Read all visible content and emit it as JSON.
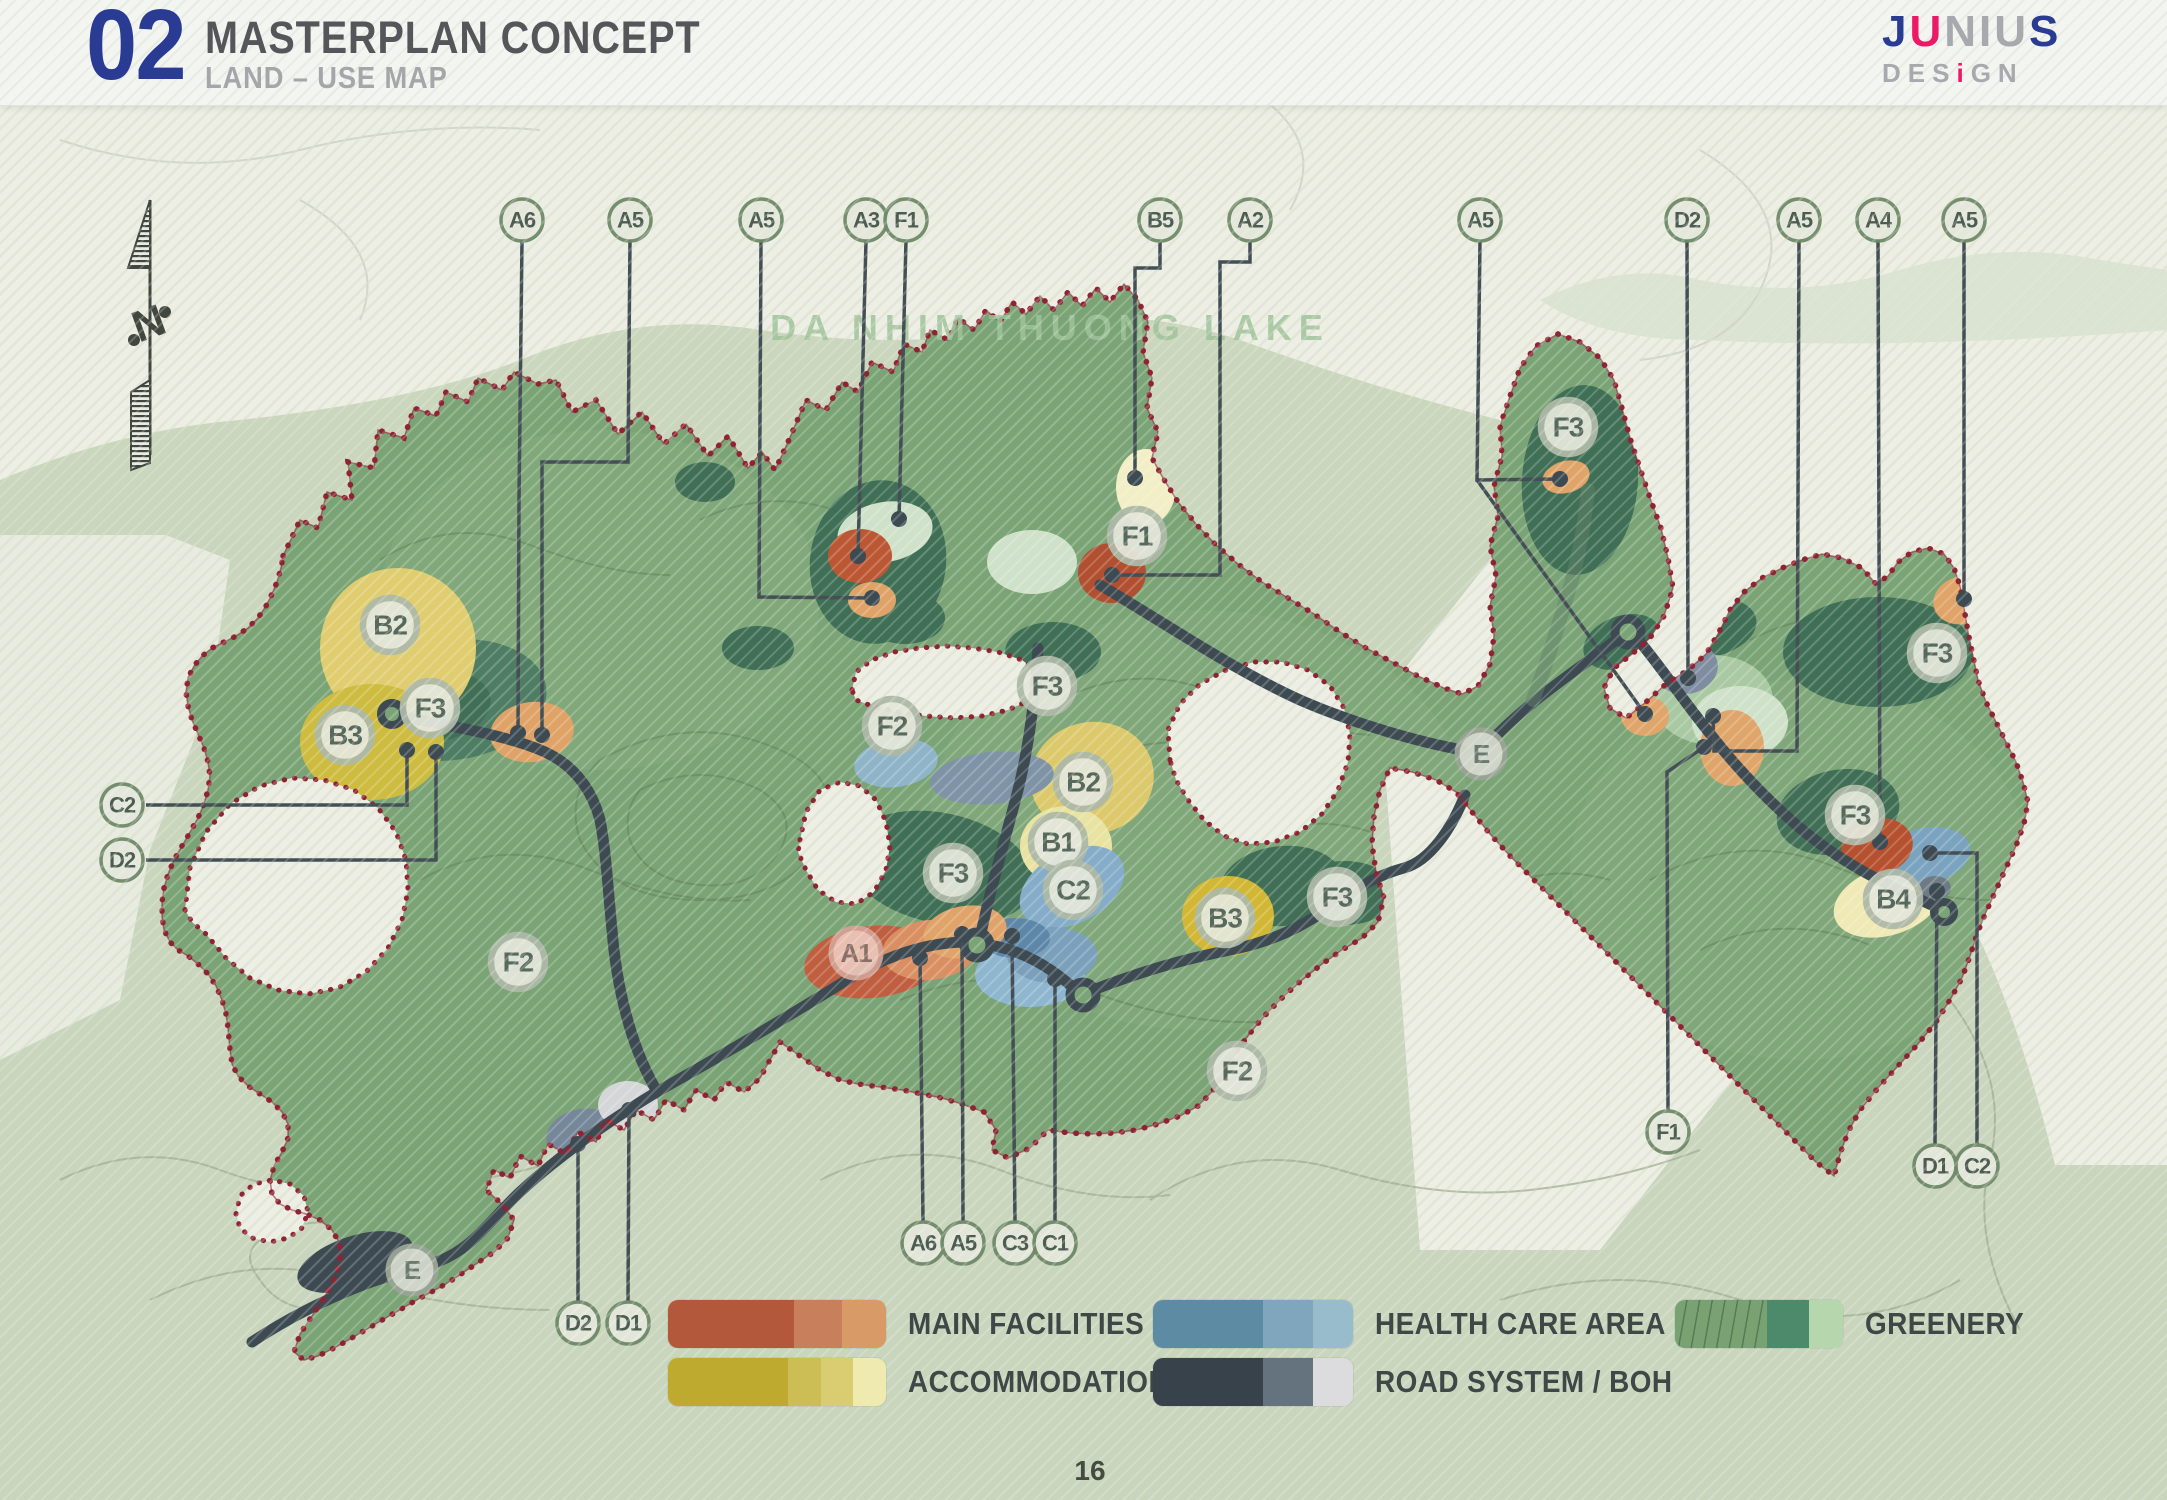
{
  "header": {
    "number": "02",
    "title": "MASTERPLAN CONCEPT",
    "subtitle": "LAND – USE MAP"
  },
  "logo": {
    "line1_j": "J",
    "line1_u": "U",
    "line1_rest": "NIU",
    "line1_s": "S",
    "line2_pre": "DES",
    "line2_i": "i",
    "line2_post": "GN"
  },
  "map": {
    "lake_label": "DA NHIM THUONG LAKE",
    "north_label": "N",
    "markers": [
      {
        "label": "B2",
        "x": 390,
        "y": 625,
        "kind": "zone"
      },
      {
        "label": "B3",
        "x": 345,
        "y": 735,
        "kind": "zone"
      },
      {
        "label": "F3",
        "x": 430,
        "y": 708,
        "kind": "zone"
      },
      {
        "label": "F2",
        "x": 518,
        "y": 962,
        "kind": "zone"
      },
      {
        "label": "F2",
        "x": 892,
        "y": 726,
        "kind": "zone"
      },
      {
        "label": "F3",
        "x": 1047,
        "y": 686,
        "kind": "zone"
      },
      {
        "label": "F1",
        "x": 1137,
        "y": 536,
        "kind": "zone"
      },
      {
        "label": "B2",
        "x": 1083,
        "y": 782,
        "kind": "zone"
      },
      {
        "label": "B1",
        "x": 1058,
        "y": 842,
        "kind": "zone"
      },
      {
        "label": "C2",
        "x": 1073,
        "y": 890,
        "kind": "zone"
      },
      {
        "label": "F3",
        "x": 953,
        "y": 873,
        "kind": "zone"
      },
      {
        "label": "B3",
        "x": 1225,
        "y": 918,
        "kind": "zone"
      },
      {
        "label": "F3",
        "x": 1337,
        "y": 897,
        "kind": "zone"
      },
      {
        "label": "F2",
        "x": 1237,
        "y": 1071,
        "kind": "zone"
      },
      {
        "label": "E",
        "x": 1481,
        "y": 754,
        "kind": "e"
      },
      {
        "label": "F3",
        "x": 1568,
        "y": 427,
        "kind": "zone"
      },
      {
        "label": "F3",
        "x": 1937,
        "y": 653,
        "kind": "zone"
      },
      {
        "label": "F3",
        "x": 1855,
        "y": 815,
        "kind": "zone"
      },
      {
        "label": "B4",
        "x": 1893,
        "y": 899,
        "kind": "zone"
      },
      {
        "label": "A1",
        "x": 856,
        "y": 953,
        "kind": "pink"
      },
      {
        "label": "E",
        "x": 412,
        "y": 1270,
        "kind": "e"
      },
      {
        "label": "A6",
        "x": 522,
        "y": 220,
        "kind": "stop"
      },
      {
        "label": "A5",
        "x": 630,
        "y": 220,
        "kind": "stop"
      },
      {
        "label": "A5",
        "x": 761,
        "y": 220,
        "kind": "stop"
      },
      {
        "label": "A3",
        "x": 866,
        "y": 220,
        "kind": "stop"
      },
      {
        "label": "F1",
        "x": 906,
        "y": 220,
        "kind": "stop"
      },
      {
        "label": "B5",
        "x": 1160,
        "y": 220,
        "kind": "stop"
      },
      {
        "label": "A2",
        "x": 1250,
        "y": 220,
        "kind": "stop"
      },
      {
        "label": "A5",
        "x": 1480,
        "y": 220,
        "kind": "stop"
      },
      {
        "label": "D2",
        "x": 1687,
        "y": 220,
        "kind": "stop"
      },
      {
        "label": "A5",
        "x": 1799,
        "y": 220,
        "kind": "stop"
      },
      {
        "label": "A4",
        "x": 1878,
        "y": 220,
        "kind": "stop"
      },
      {
        "label": "A5",
        "x": 1964,
        "y": 220,
        "kind": "stop"
      },
      {
        "label": "C2",
        "x": 122,
        "y": 805,
        "kind": "stop"
      },
      {
        "label": "D2",
        "x": 122,
        "y": 860,
        "kind": "stop"
      },
      {
        "label": "A6",
        "x": 923,
        "y": 1243,
        "kind": "stop"
      },
      {
        "label": "A5",
        "x": 963,
        "y": 1243,
        "kind": "stop"
      },
      {
        "label": "C3",
        "x": 1015,
        "y": 1243,
        "kind": "stop"
      },
      {
        "label": "C1",
        "x": 1055,
        "y": 1243,
        "kind": "stop"
      },
      {
        "label": "D2",
        "x": 578,
        "y": 1323,
        "kind": "stop"
      },
      {
        "label": "D1",
        "x": 628,
        "y": 1323,
        "kind": "stop"
      },
      {
        "label": "F1",
        "x": 1668,
        "y": 1132,
        "kind": "stop"
      },
      {
        "label": "D1",
        "x": 1935,
        "y": 1166,
        "kind": "stop"
      },
      {
        "label": "C2",
        "x": 1977,
        "y": 1166,
        "kind": "stop"
      }
    ],
    "leaders": [
      {
        "points": "522,240 519,500 518,733"
      },
      {
        "points": "630,240 628,462 542,462 542,735"
      },
      {
        "points": "761,240 759,597 872,598"
      },
      {
        "points": "866,240 858,556"
      },
      {
        "points": "906,240 899,519"
      },
      {
        "points": "1160,240 1160,268 1135,268 1135,478"
      },
      {
        "points": "1250,240 1250,262 1220,262 1220,575 1112,575"
      },
      {
        "points": "1480,240 1477,480 1560,479"
      },
      {
        "points": "1477,480 1645,714"
      },
      {
        "points": "1687,240 1688,678"
      },
      {
        "points": "1799,240 1797,751 1714,751 1713,716"
      },
      {
        "points": "1878,240 1880,842"
      },
      {
        "points": "1964,240 1964,599"
      },
      {
        "points": "146,805 407,805 407,750"
      },
      {
        "points": "146,860 436,860 436,752"
      },
      {
        "points": "923,1221 920,958"
      },
      {
        "points": "963,1221 962,934"
      },
      {
        "points": "1015,1221 1012,936"
      },
      {
        "points": "1055,1221 1055,979"
      },
      {
        "points": "578,1301 578,1144"
      },
      {
        "points": "628,1301 629,1110"
      },
      {
        "points": "1668,1110 1667,772 1704,747"
      },
      {
        "points": "1935,1144 1937,891"
      },
      {
        "points": "1977,1144 1977,853 1930,853"
      }
    ]
  },
  "legend": {
    "items": [
      {
        "label": "MAIN FACILITIES",
        "colors": [
          "#b4583c",
          "#c87f5c",
          "#d89a66"
        ],
        "widths": [
          58,
          22,
          20
        ],
        "contour": false
      },
      {
        "label": "ACCOMMODATION",
        "colors": [
          "#bfaa30",
          "#ccbd55",
          "#d9cd72",
          "#eeeab0"
        ],
        "widths": [
          55,
          15,
          15,
          15
        ],
        "contour": false
      },
      {
        "label": "HEALTH CARE AREA",
        "colors": [
          "#5d8ba3",
          "#7fa6bd",
          "#99bccd"
        ],
        "widths": [
          55,
          25,
          20
        ],
        "contour": false
      },
      {
        "label": "ROAD SYSTEM / BOH",
        "colors": [
          "#37424a",
          "#65737f",
          "#dcdcdf"
        ],
        "widths": [
          55,
          25,
          20
        ],
        "contour": false
      },
      {
        "label": "GREENERY",
        "colors": [
          "#78a271",
          "#4c8a6b",
          "#b6d7ae"
        ],
        "widths": [
          55,
          25,
          20
        ],
        "contour": true
      }
    ]
  },
  "page_number": "16",
  "colors": {
    "accent_blue": "#2a3b94",
    "accent_pink": "#ec1a66",
    "site_green": "#7ba476",
    "dark_green": "#3a6a52",
    "pale_green": "#cfe2c9",
    "boundary_red": "#8e2433",
    "road": "#3d4a52",
    "sage_bg": "#c9d5bc",
    "lake_bg": "#ecefe6"
  }
}
